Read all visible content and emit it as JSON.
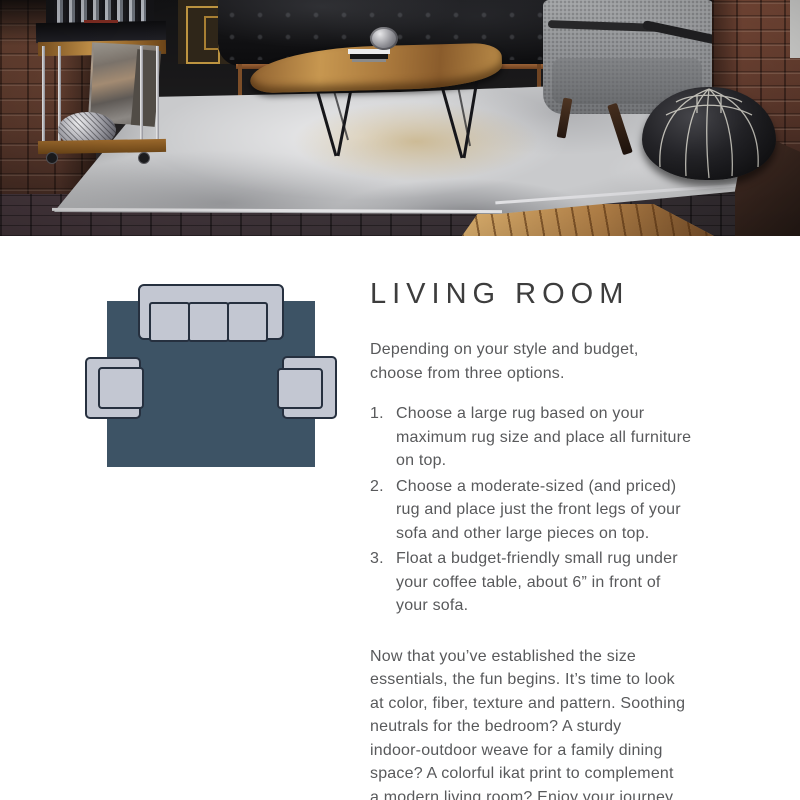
{
  "theme": {
    "page_bg": "#ffffff",
    "heading_color": "#3d3d3d",
    "body_color": "#58595b",
    "diagram_rug": "#3d5365",
    "diagram_furniture_fill": "#c3c7d2",
    "diagram_furniture_outline": "#26303f",
    "photo_rug": "#c9cacc",
    "photo_rug_stain": "#ba9955",
    "brick_wall": "#5f392c"
  },
  "article": {
    "title": "LIVING ROOM",
    "intro": "Depending on your style and budget,\nchoose from three options.",
    "options": [
      {
        "number": "1.",
        "text": "Choose a large rug based on your\nmaximum rug size and place all furniture\non top."
      },
      {
        "number": "2.",
        "text": "Choose a moderate-sized (and priced)\nrug and place just the front legs of your\nsofa and other large pieces on top."
      },
      {
        "number": "3.",
        "text": "Float a budget-friendly small rug under\nyour coffee table, about 6” in front of\nyour sofa."
      }
    ],
    "outro": "Now that you’ve established the size\nessentials, the fun begins. It’s time to look\nat color, fiber, texture and pattern. Soothing\nneutrals for the bedroom? A sturdy\nindoor-outdoor weave for a family dining\nspace? A colorful ikat print to complement\na modern living room? Enjoy your journey"
  }
}
